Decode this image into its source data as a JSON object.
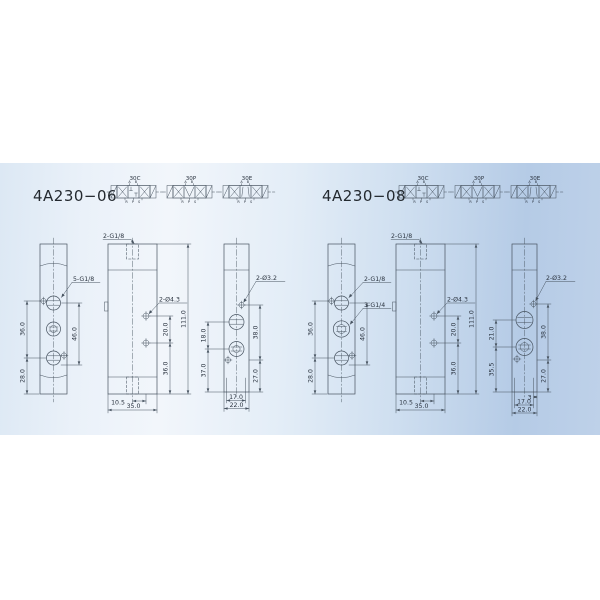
{
  "colors": {
    "background": "#ffffff",
    "band_left": "#dce8f4",
    "band_mid": "#f2f6fb",
    "band_right": "#b5cbe6",
    "line": "#46525f",
    "text": "#2b3440"
  },
  "products": [
    {
      "model": "4A230−06",
      "symbols": [
        {
          "label": "30C",
          "ports_top": "A B",
          "ports_bottom": "R P S"
        },
        {
          "label": "30P",
          "ports_top": "A B",
          "ports_bottom": "R P S"
        },
        {
          "label": "30E",
          "ports_top": "A B",
          "ports_bottom": "R P S"
        }
      ],
      "port_view": {
        "thread_label": "5-G1/8",
        "dim_upper_left": "36.0",
        "dim_lower_left": "28.0",
        "dim_right": "46.0"
      },
      "front_view": {
        "thread_label": "2-G1/8",
        "hole_label": "2-Ø4.3",
        "dim_hole_spacing": "20.0",
        "dim_hole_bottom": "36.0",
        "dim_height": "111.0",
        "dim_offset": "10.5",
        "dim_width": "35.0"
      },
      "side_view": {
        "hole_label": "2-Ø3.2",
        "dim_upper_left": "18.0",
        "dim_lower_left": "37.0",
        "dim_upper_right": "38.0",
        "dim_lower_right": "27.0",
        "dim_inner_width": "17.0",
        "dim_width": "22.0"
      }
    },
    {
      "model": "4A230−08",
      "symbols": [
        {
          "label": "30C",
          "ports_top": "A B",
          "ports_bottom": "R P S"
        },
        {
          "label": "30P",
          "ports_top": "A B",
          "ports_bottom": "R P S"
        },
        {
          "label": "30E",
          "ports_top": "A B",
          "ports_bottom": "R P S"
        }
      ],
      "port_view": {
        "thread_label_top": "2-G1/8",
        "thread_label_mid": "3-G1/4",
        "dim_upper_left": "36.0",
        "dim_lower_left": "28.0",
        "dim_right": "46.0"
      },
      "front_view": {
        "thread_label": "2-G1/8",
        "hole_label": "2-Ø4.3",
        "dim_hole_spacing": "20.0",
        "dim_hole_bottom": "36.0",
        "dim_height": "111.0",
        "dim_offset": "10.5",
        "dim_width": "35.0"
      },
      "side_view": {
        "hole_label": "2-Ø3.2",
        "dim_upper_left": "21.0",
        "dim_lower_left": "35.5",
        "dim_upper_right": "38.0",
        "dim_lower_right": "27.0",
        "dim_step": "3",
        "dim_inner_width": "17.0",
        "dim_width": "22.0"
      }
    }
  ]
}
